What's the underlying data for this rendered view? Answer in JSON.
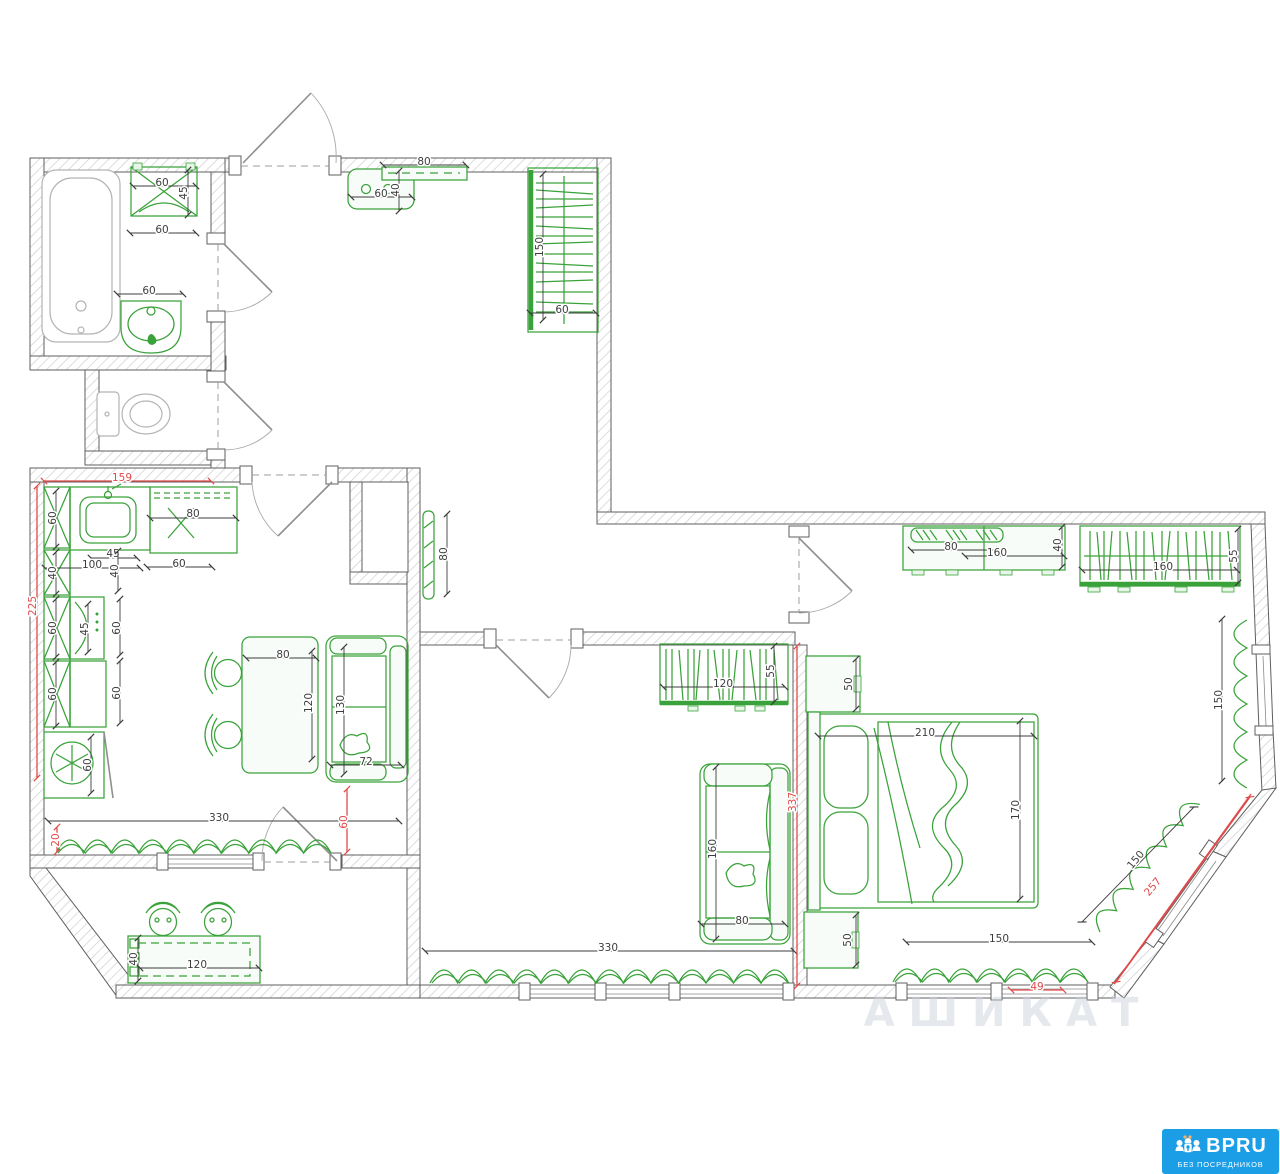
{
  "document": {
    "type": "apartment-floor-plan",
    "units": "cm"
  },
  "watermark": {
    "text": "АШИКАТ"
  },
  "logo": {
    "brand": "BPRU",
    "tagline": "БЕЗ ПОСРЕДНИКОВ",
    "bg_color": "#1b9ee6",
    "text_color": "#ffffff"
  },
  "colors": {
    "furniture_green": "#3aa23a",
    "fixture_gray": "#b4b4b4",
    "wall_outline": "#5f5f5f",
    "dimension_text": "#3d3d3d",
    "red_dimension": "#e04a4a"
  },
  "dimensions": [
    {
      "value": "60",
      "of": "washer-width",
      "x": 162,
      "y": 183,
      "rot": 0,
      "color": "black",
      "line": [
        133,
        186,
        196,
        186
      ]
    },
    {
      "value": "45",
      "of": "washer-depth",
      "x": 184,
      "y": 193,
      "rot": -90,
      "color": "black",
      "line": [
        188,
        170,
        188,
        215
      ]
    },
    {
      "value": "60",
      "of": "washer-clearance",
      "x": 162,
      "y": 230,
      "rot": 0,
      "color": "black",
      "line": [
        130,
        233,
        196,
        233
      ]
    },
    {
      "value": "60",
      "of": "bath-sink-width",
      "x": 149,
      "y": 291,
      "rot": 0,
      "color": "black",
      "line": [
        117,
        294,
        183,
        294
      ]
    },
    {
      "value": "80",
      "of": "hall-shelf-width",
      "x": 424,
      "y": 162,
      "rot": 0,
      "color": "black",
      "line": [
        383,
        165,
        466,
        165
      ]
    },
    {
      "value": "60",
      "of": "hall-bench-width",
      "x": 381,
      "y": 194,
      "rot": 0,
      "color": "black",
      "line": [
        351,
        197,
        412,
        197
      ]
    },
    {
      "value": "40",
      "of": "hall-bench-depth",
      "x": 396,
      "y": 190,
      "rot": -90,
      "color": "black",
      "line": [
        399,
        171,
        399,
        211
      ]
    },
    {
      "value": "150",
      "of": "hall-wardrobe-length",
      "x": 540,
      "y": 247,
      "rot": -90,
      "color": "black",
      "line": [
        543,
        174,
        543,
        320
      ]
    },
    {
      "value": "60",
      "of": "hall-wardrobe-depth",
      "x": 562,
      "y": 310,
      "rot": 0,
      "color": "black",
      "line": [
        530,
        313,
        596,
        313
      ]
    },
    {
      "value": "80",
      "of": "corridor-radiator",
      "x": 444,
      "y": 554,
      "rot": -90,
      "color": "black",
      "line": [
        447,
        514,
        447,
        594
      ]
    },
    {
      "value": "60",
      "of": "kitchen-cabinet-a",
      "x": 53,
      "y": 518,
      "rot": -90,
      "color": "black",
      "line": [
        56,
        491,
        56,
        547
      ]
    },
    {
      "value": "80",
      "of": "kitchen-hob-width",
      "x": 193,
      "y": 514,
      "rot": 0,
      "color": "black",
      "line": [
        150,
        518,
        236,
        518
      ]
    },
    {
      "value": "45",
      "of": "kitchen-counter-45",
      "x": 113,
      "y": 554,
      "rot": 0,
      "color": "black",
      "line": [
        91,
        558,
        137,
        558
      ]
    },
    {
      "value": "100",
      "of": "kitchen-counter-100",
      "x": 92,
      "y": 565,
      "rot": 0,
      "color": "black",
      "line": [
        45,
        568,
        140,
        568
      ]
    },
    {
      "value": "40",
      "of": "kitchen-counter-40",
      "x": 115,
      "y": 571,
      "rot": -90,
      "color": "black",
      "line": [
        118,
        551,
        118,
        591
      ]
    },
    {
      "value": "60",
      "of": "kitchen-counter-60",
      "x": 179,
      "y": 564,
      "rot": 0,
      "color": "black",
      "line": [
        147,
        567,
        212,
        567
      ]
    },
    {
      "value": "40",
      "of": "kitchen-cabinet-b",
      "x": 53,
      "y": 573,
      "rot": -90,
      "color": "black",
      "line": [
        56,
        552,
        56,
        594
      ]
    },
    {
      "value": "60",
      "of": "kitchen-cabinet-c",
      "x": 53,
      "y": 628,
      "rot": -90,
      "color": "black",
      "line": [
        56,
        599,
        56,
        657
      ]
    },
    {
      "value": "45",
      "of": "kitchen-oven-width",
      "x": 85,
      "y": 629,
      "rot": -90,
      "color": "black",
      "line": [
        88,
        604,
        88,
        652
      ]
    },
    {
      "value": "60",
      "of": "kitchen-worktop-a",
      "x": 117,
      "y": 628,
      "rot": -90,
      "color": "black",
      "line": [
        120,
        599,
        120,
        655
      ]
    },
    {
      "value": "60",
      "of": "kitchen-cabinet-d",
      "x": 53,
      "y": 694,
      "rot": -90,
      "color": "black",
      "line": [
        56,
        662,
        56,
        726
      ]
    },
    {
      "value": "60",
      "of": "kitchen-worktop-b",
      "x": 117,
      "y": 693,
      "rot": -90,
      "color": "black",
      "line": [
        120,
        661,
        120,
        723
      ]
    },
    {
      "value": "60",
      "of": "fridge-width",
      "x": 88,
      "y": 765,
      "rot": -90,
      "color": "black",
      "line": [
        91,
        737,
        91,
        793
      ]
    },
    {
      "value": "80",
      "of": "dining-table-width",
      "x": 283,
      "y": 655,
      "rot": 0,
      "color": "black",
      "line": [
        246,
        658,
        316,
        658
      ]
    },
    {
      "value": "120",
      "of": "dining-table-length",
      "x": 309,
      "y": 703,
      "rot": -90,
      "color": "black",
      "line": [
        312,
        651,
        312,
        759
      ]
    },
    {
      "value": "130",
      "of": "loveseat-length",
      "x": 341,
      "y": 705,
      "rot": -90,
      "color": "black",
      "line": [
        344,
        647,
        344,
        774
      ]
    },
    {
      "value": "72",
      "of": "loveseat-depth",
      "x": 366,
      "y": 762,
      "rot": 0,
      "color": "black",
      "line": [
        330,
        765,
        401,
        765
      ]
    },
    {
      "value": "330",
      "of": "kitchen-window-wall",
      "x": 219,
      "y": 818,
      "rot": 0,
      "color": "black",
      "line": [
        48,
        821,
        399,
        821
      ]
    },
    {
      "value": "120",
      "of": "bar-table-length",
      "x": 197,
      "y": 965,
      "rot": 0,
      "color": "black",
      "line": [
        140,
        968,
        259,
        968
      ]
    },
    {
      "value": "40",
      "of": "bar-table-depth",
      "x": 134,
      "y": 959,
      "rot": -90,
      "color": "black",
      "line": [
        138,
        938,
        138,
        981
      ]
    },
    {
      "value": "120",
      "of": "bookshelf-length",
      "x": 723,
      "y": 684,
      "rot": 0,
      "color": "black",
      "line": [
        663,
        687,
        785,
        687
      ]
    },
    {
      "value": "55",
      "of": "bookshelf-depth",
      "x": 771,
      "y": 671,
      "rot": -90,
      "color": "black",
      "line": [
        774,
        646,
        774,
        702
      ]
    },
    {
      "value": "160",
      "of": "sofa-length",
      "x": 713,
      "y": 849,
      "rot": -90,
      "color": "black",
      "line": [
        716,
        767,
        716,
        939
      ]
    },
    {
      "value": "80",
      "of": "sofa-depth",
      "x": 742,
      "y": 921,
      "rot": 0,
      "color": "black",
      "line": [
        701,
        924,
        785,
        924
      ]
    },
    {
      "value": "330",
      "of": "living-window-wall",
      "x": 608,
      "y": 948,
      "rot": 0,
      "color": "black",
      "line": [
        425,
        951,
        794,
        951
      ]
    },
    {
      "value": "80",
      "of": "bedroom-dresser-a",
      "x": 951,
      "y": 547,
      "rot": 0,
      "color": "black",
      "line": [
        911,
        550,
        999,
        550
      ]
    },
    {
      "value": "160",
      "of": "bedroom-dresser-length",
      "x": 997,
      "y": 553,
      "rot": 0,
      "color": "black",
      "line": [
        965,
        556,
        1064,
        556
      ]
    },
    {
      "value": "40",
      "of": "bedroom-dresser-depth",
      "x": 1058,
      "y": 545,
      "rot": -90,
      "color": "black",
      "line": [
        1062,
        527,
        1062,
        567
      ]
    },
    {
      "value": "160",
      "of": "bedroom-wardrobe-length",
      "x": 1163,
      "y": 567,
      "rot": 0,
      "color": "black",
      "line": [
        1082,
        570,
        1237,
        570
      ]
    },
    {
      "value": "55",
      "of": "bedroom-wardrobe-depth",
      "x": 1234,
      "y": 556,
      "rot": -90,
      "color": "black",
      "line": [
        1238,
        529,
        1238,
        583
      ]
    },
    {
      "value": "50",
      "of": "nightstand-a",
      "x": 849,
      "y": 684,
      "rot": -90,
      "color": "black",
      "line": [
        856,
        659,
        856,
        709
      ]
    },
    {
      "value": "210",
      "of": "bed-width",
      "x": 925,
      "y": 733,
      "rot": 0,
      "color": "black",
      "line": [
        818,
        736,
        1034,
        736
      ]
    },
    {
      "value": "170",
      "of": "bed-length",
      "x": 1016,
      "y": 810,
      "rot": -90,
      "color": "black",
      "line": [
        1020,
        721,
        1020,
        899
      ]
    },
    {
      "value": "50",
      "of": "nightstand-b",
      "x": 848,
      "y": 940,
      "rot": -90,
      "color": "black",
      "line": [
        856,
        915,
        856,
        965
      ]
    },
    {
      "value": "150",
      "of": "bedroom-window-wall",
      "x": 999,
      "y": 939,
      "rot": 0,
      "color": "black",
      "line": [
        906,
        942,
        1092,
        942
      ]
    },
    {
      "value": "150",
      "of": "bedroom-right-window",
      "x": 1219,
      "y": 700,
      "rot": -90,
      "color": "black",
      "line": [
        1222,
        619,
        1222,
        781
      ]
    },
    {
      "value": "150",
      "of": "bedroom-diagonal-window",
      "x": 1136,
      "y": 860,
      "rot": -50,
      "color": "black",
      "line": [
        1082,
        922,
        1194,
        807
      ]
    },
    {
      "value": "159",
      "of": "kitchen-top-wall",
      "x": 122,
      "y": 478,
      "rot": 0,
      "color": "red",
      "line": [
        44,
        481,
        211,
        481
      ]
    },
    {
      "value": "225",
      "of": "kitchen-left-wall",
      "x": 33,
      "y": 606,
      "rot": -90,
      "color": "red",
      "line": [
        37,
        486,
        37,
        778
      ]
    },
    {
      "value": "20",
      "of": "kitchen-window-offset",
      "x": 56,
      "y": 840,
      "rot": -90,
      "color": "red",
      "line": [
        57,
        827,
        57,
        852
      ]
    },
    {
      "value": "60",
      "of": "balcony-door-width",
      "x": 344,
      "y": 822,
      "rot": -90,
      "color": "red",
      "line": [
        347,
        789,
        347,
        852
      ]
    },
    {
      "value": "337",
      "of": "bedroom-west-wall",
      "x": 793,
      "y": 802,
      "rot": -90,
      "color": "red",
      "line": [
        797,
        646,
        797,
        986
      ]
    },
    {
      "value": "257",
      "of": "bedroom-diagonal-wall",
      "x": 1153,
      "y": 887,
      "rot": -50,
      "color": "red",
      "line": [
        1250,
        797,
        1116,
        982
      ]
    },
    {
      "value": "49",
      "of": "bedroom-window-offset",
      "x": 1037,
      "y": 987,
      "rot": 0,
      "color": "red",
      "line": [
        1011,
        990,
        1063,
        990
      ]
    }
  ]
}
